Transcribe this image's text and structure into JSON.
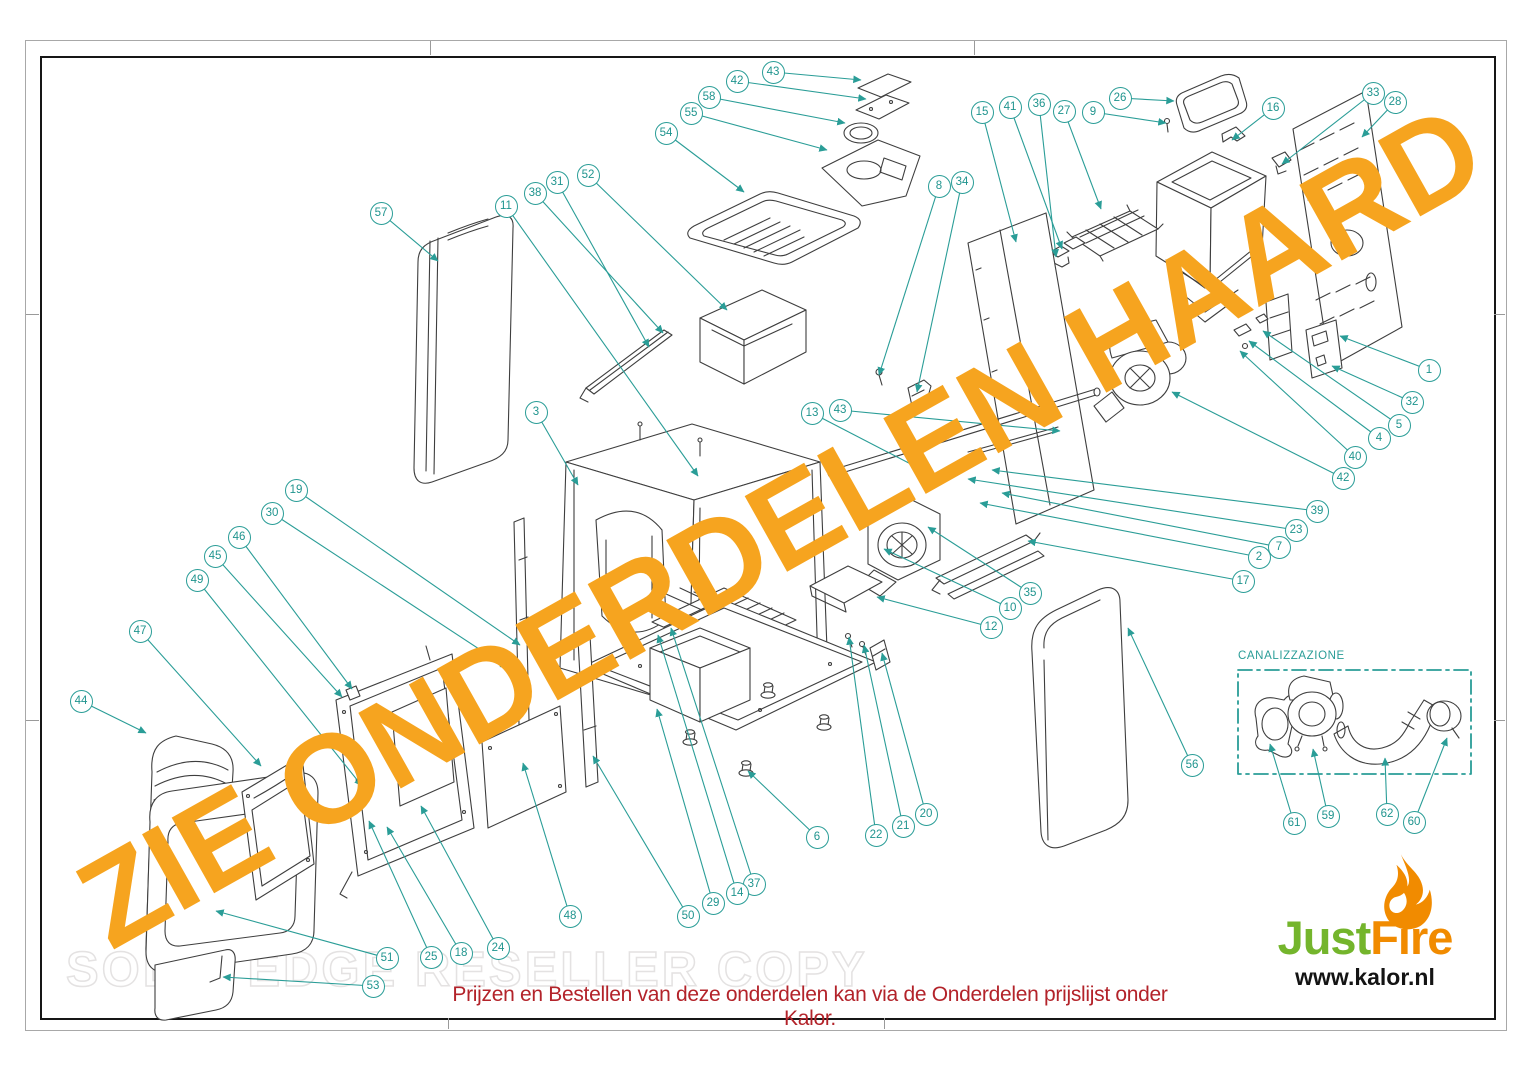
{
  "watermarks": {
    "diagonal_text": "ZIE ONDERDELEN HAARD",
    "ghost_text": "SOLID EDGE RESELLER COPY"
  },
  "note": {
    "text": "Prijzen en Bestellen van deze onderdelen kan via de Onderdelen prijslijst onder Kalor."
  },
  "canalizzazione": {
    "label": "CANALIZZAZIONE"
  },
  "logo": {
    "brand_green": "Just",
    "brand_orange": "Fire",
    "website": "www.kalor.nl",
    "flame_icon": "flame-icon"
  },
  "colors": {
    "callout_teal": "#2a9d97",
    "drawing_line": "#3e3e3e",
    "watermark_orange": "#f6a41f",
    "note_red": "#b3232a",
    "logo_green": "#74b52c",
    "logo_orange": "#f18b00"
  },
  "diagram": {
    "callouts": [
      {
        "id": "57",
        "label": "57",
        "x": 381,
        "y": 213,
        "tx": 438,
        "ty": 261
      },
      {
        "id": "11",
        "label": "11",
        "x": 506,
        "y": 206,
        "tx": 698,
        "ty": 476
      },
      {
        "id": "38",
        "label": "38",
        "x": 535,
        "y": 193,
        "tx": 663,
        "ty": 333
      },
      {
        "id": "31",
        "label": "31",
        "x": 557,
        "y": 182,
        "tx": 649,
        "ty": 347
      },
      {
        "id": "52",
        "label": "52",
        "x": 588,
        "y": 175,
        "tx": 727,
        "ty": 310
      },
      {
        "id": "54",
        "label": "54",
        "x": 666,
        "y": 133,
        "tx": 744,
        "ty": 192
      },
      {
        "id": "55",
        "label": "55",
        "x": 691,
        "y": 113,
        "tx": 827,
        "ty": 150
      },
      {
        "id": "58",
        "label": "58",
        "x": 709,
        "y": 97,
        "tx": 845,
        "ty": 123
      },
      {
        "id": "42",
        "label": "42",
        "x": 737,
        "y": 81,
        "tx": 866,
        "ty": 99
      },
      {
        "id": "43",
        "label": "43",
        "x": 773,
        "y": 72,
        "tx": 861,
        "ty": 80
      },
      {
        "id": "8",
        "label": "8",
        "x": 939,
        "y": 186,
        "tx": 879,
        "ty": 375
      },
      {
        "id": "34",
        "label": "34",
        "x": 962,
        "y": 182,
        "tx": 917,
        "ty": 392
      },
      {
        "id": "15",
        "label": "15",
        "x": 982,
        "y": 112,
        "tx": 1016,
        "ty": 242
      },
      {
        "id": "41",
        "label": "41",
        "x": 1010,
        "y": 107,
        "tx": 1062,
        "ty": 249
      },
      {
        "id": "36",
        "label": "36",
        "x": 1039,
        "y": 104,
        "tx": 1056,
        "ty": 257
      },
      {
        "id": "27",
        "label": "27",
        "x": 1064,
        "y": 111,
        "tx": 1101,
        "ty": 209
      },
      {
        "id": "9",
        "label": "9",
        "x": 1093,
        "y": 112,
        "tx": 1166,
        "ty": 123
      },
      {
        "id": "26",
        "label": "26",
        "x": 1120,
        "y": 98,
        "tx": 1174,
        "ty": 101
      },
      {
        "id": "16",
        "label": "16",
        "x": 1273,
        "y": 108,
        "tx": 1232,
        "ty": 140
      },
      {
        "id": "33",
        "label": "33",
        "x": 1373,
        "y": 93,
        "tx": 1282,
        "ty": 164
      },
      {
        "id": "28",
        "label": "28",
        "x": 1395,
        "y": 102,
        "tx": 1362,
        "ty": 137
      },
      {
        "id": "1",
        "label": "1",
        "x": 1429,
        "y": 370,
        "tx": 1340,
        "ty": 336
      },
      {
        "id": "32",
        "label": "32",
        "x": 1412,
        "y": 402,
        "tx": 1332,
        "ty": 366
      },
      {
        "id": "5",
        "label": "5",
        "x": 1399,
        "y": 425,
        "tx": 1263,
        "ty": 331
      },
      {
        "id": "4",
        "label": "4",
        "x": 1379,
        "y": 438,
        "tx": 1249,
        "ty": 341
      },
      {
        "id": "40",
        "label": "40",
        "x": 1355,
        "y": 457,
        "tx": 1240,
        "ty": 351
      },
      {
        "id": "42b",
        "label": "42",
        "x": 1343,
        "y": 478,
        "tx": 1172,
        "ty": 392
      },
      {
        "id": "39",
        "label": "39",
        "x": 1317,
        "y": 511,
        "tx": 992,
        "ty": 470
      },
      {
        "id": "23",
        "label": "23",
        "x": 1296,
        "y": 530,
        "tx": 968,
        "ty": 479
      },
      {
        "id": "7",
        "label": "7",
        "x": 1279,
        "y": 547,
        "tx": 1002,
        "ty": 493
      },
      {
        "id": "2",
        "label": "2",
        "x": 1259,
        "y": 557,
        "tx": 980,
        "ty": 503
      },
      {
        "id": "17",
        "label": "17",
        "x": 1243,
        "y": 581,
        "tx": 1028,
        "ty": 541
      },
      {
        "id": "13",
        "label": "13",
        "x": 812,
        "y": 413,
        "tx": 930,
        "ty": 474
      },
      {
        "id": "43b",
        "label": "43",
        "x": 840,
        "y": 410,
        "tx": 1060,
        "ty": 431
      },
      {
        "id": "3",
        "label": "3",
        "x": 536,
        "y": 412,
        "tx": 578,
        "ty": 485
      },
      {
        "id": "19",
        "label": "19",
        "x": 296,
        "y": 490,
        "tx": 520,
        "ty": 645
      },
      {
        "id": "30",
        "label": "30",
        "x": 272,
        "y": 513,
        "tx": 508,
        "ty": 668
      },
      {
        "id": "46",
        "label": "46",
        "x": 239,
        "y": 537,
        "tx": 352,
        "ty": 689
      },
      {
        "id": "45",
        "label": "45",
        "x": 215,
        "y": 556,
        "tx": 342,
        "ty": 697
      },
      {
        "id": "49",
        "label": "49",
        "x": 197,
        "y": 580,
        "tx": 362,
        "ty": 786
      },
      {
        "id": "47",
        "label": "47",
        "x": 140,
        "y": 631,
        "tx": 261,
        "ty": 766
      },
      {
        "id": "44",
        "label": "44",
        "x": 81,
        "y": 701,
        "tx": 146,
        "ty": 733
      },
      {
        "id": "35",
        "label": "35",
        "x": 1030,
        "y": 593,
        "tx": 928,
        "ty": 527
      },
      {
        "id": "10",
        "label": "10",
        "x": 1010,
        "y": 608,
        "tx": 884,
        "ty": 549
      },
      {
        "id": "12",
        "label": "12",
        "x": 991,
        "y": 627,
        "tx": 877,
        "ty": 597
      },
      {
        "id": "56",
        "label": "56",
        "x": 1192,
        "y": 765,
        "tx": 1128,
        "ty": 628
      },
      {
        "id": "20",
        "label": "20",
        "x": 926,
        "y": 814,
        "tx": 882,
        "ty": 653
      },
      {
        "id": "21",
        "label": "21",
        "x": 903,
        "y": 826,
        "tx": 864,
        "ty": 645
      },
      {
        "id": "22",
        "label": "22",
        "x": 876,
        "y": 835,
        "tx": 849,
        "ty": 637
      },
      {
        "id": "6",
        "label": "6",
        "x": 817,
        "y": 837,
        "tx": 748,
        "ty": 771
      },
      {
        "id": "37",
        "label": "37",
        "x": 754,
        "y": 884,
        "tx": 671,
        "ty": 628
      },
      {
        "id": "14",
        "label": "14",
        "x": 737,
        "y": 893,
        "tx": 658,
        "ty": 635
      },
      {
        "id": "29",
        "label": "29",
        "x": 713,
        "y": 903,
        "tx": 657,
        "ty": 709
      },
      {
        "id": "50",
        "label": "50",
        "x": 688,
        "y": 916,
        "tx": 593,
        "ty": 756
      },
      {
        "id": "48",
        "label": "48",
        "x": 570,
        "y": 916,
        "tx": 523,
        "ty": 763
      },
      {
        "id": "24",
        "label": "24",
        "x": 498,
        "y": 948,
        "tx": 421,
        "ty": 806
      },
      {
        "id": "18",
        "label": "18",
        "x": 461,
        "y": 953,
        "tx": 387,
        "ty": 827
      },
      {
        "id": "25",
        "label": "25",
        "x": 431,
        "y": 957,
        "tx": 369,
        "ty": 821
      },
      {
        "id": "51",
        "label": "51",
        "x": 387,
        "y": 958,
        "tx": 216,
        "ty": 911
      },
      {
        "id": "53",
        "label": "53",
        "x": 373,
        "y": 986,
        "tx": 223,
        "ty": 977
      },
      {
        "id": "61",
        "label": "61",
        "x": 1294,
        "y": 823,
        "tx": 1270,
        "ty": 744
      },
      {
        "id": "59",
        "label": "59",
        "x": 1328,
        "y": 816,
        "tx": 1313,
        "ty": 749
      },
      {
        "id": "62",
        "label": "62",
        "x": 1387,
        "y": 814,
        "tx": 1385,
        "ty": 758
      },
      {
        "id": "60",
        "label": "60",
        "x": 1414,
        "y": 822,
        "tx": 1447,
        "ty": 738
      }
    ]
  }
}
